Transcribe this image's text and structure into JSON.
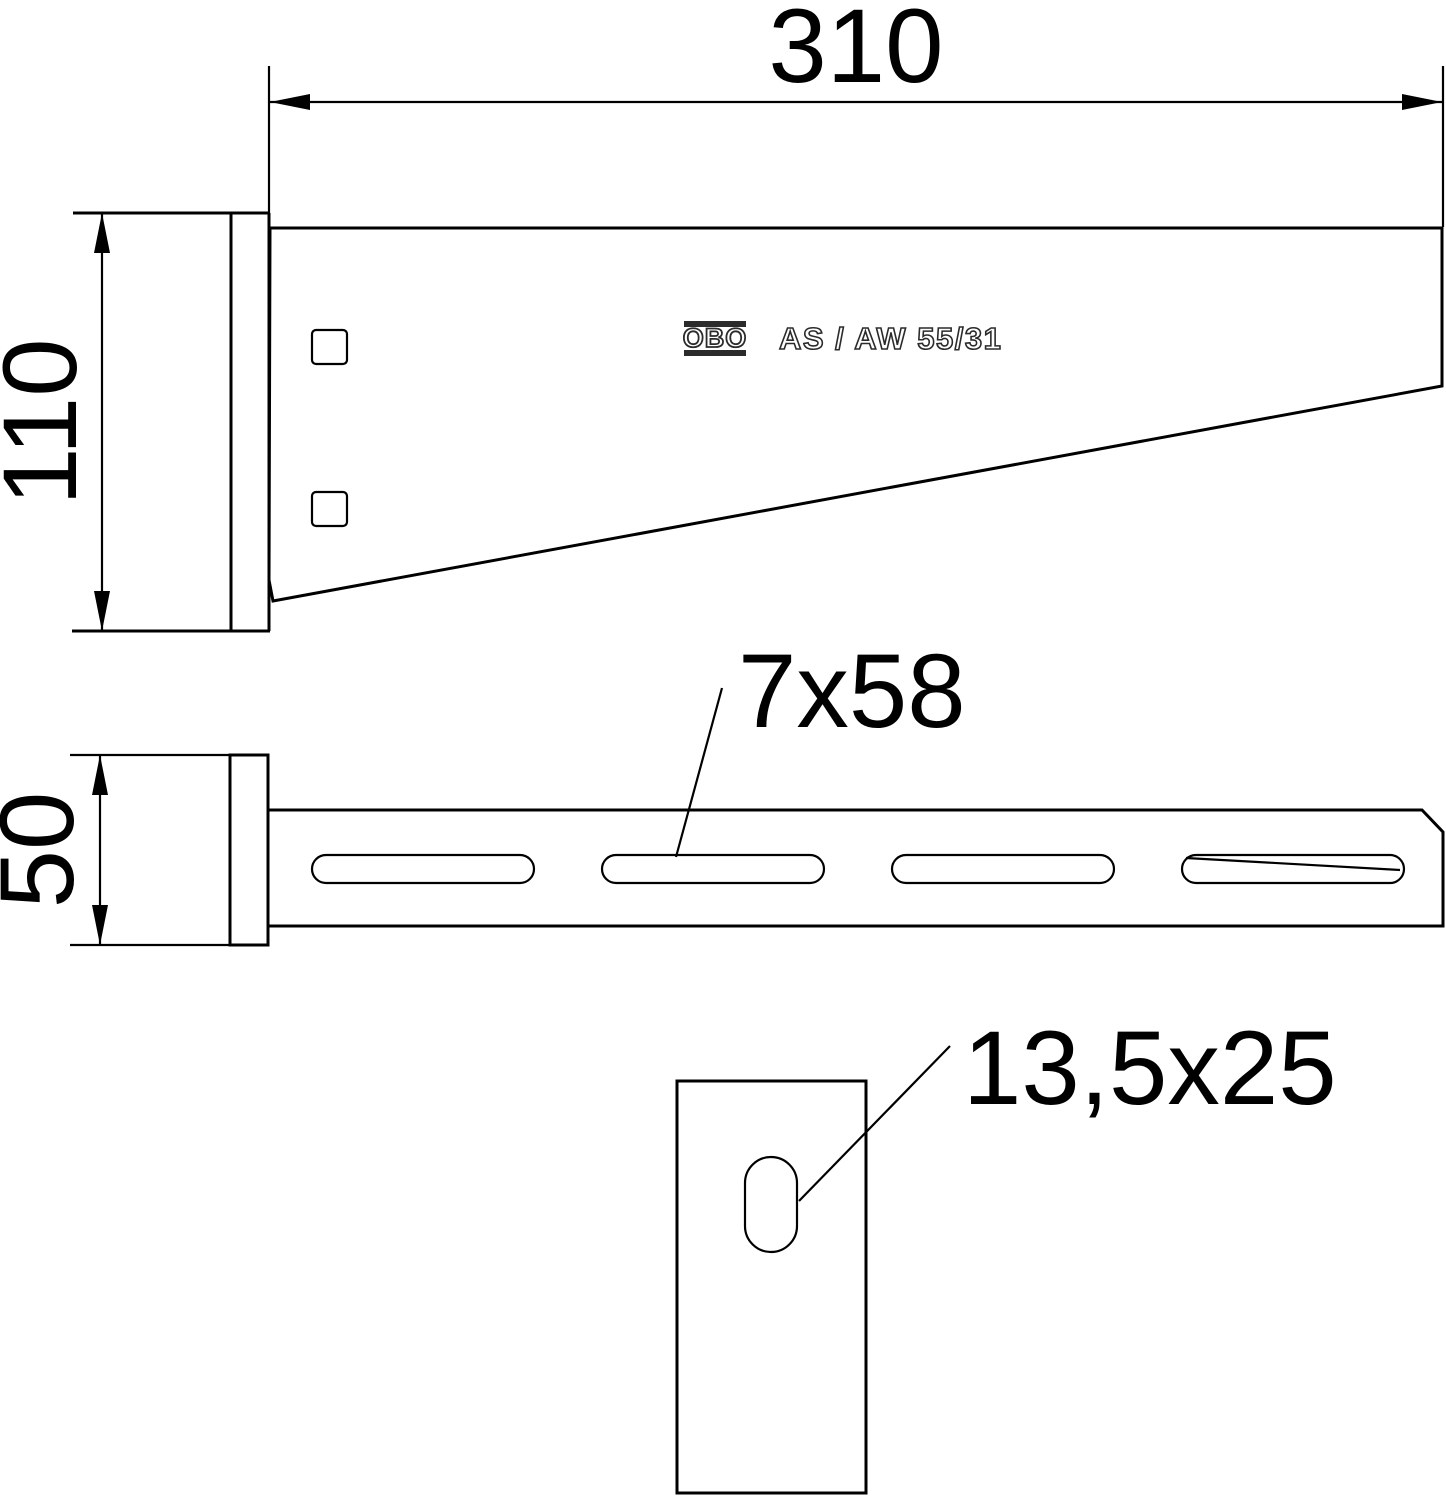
{
  "drawing": {
    "brand": "OBO",
    "product_label": "AS / AW 55/31",
    "dimensions": {
      "arm_length": "310",
      "bracket_height": "110",
      "profile_width": "50",
      "arm_slot_size": "7x58",
      "wall_slot_size": "13,5x25"
    },
    "colors": {
      "line": "#000000",
      "background": "#ffffff",
      "stamp": "#2b2b2b"
    }
  }
}
